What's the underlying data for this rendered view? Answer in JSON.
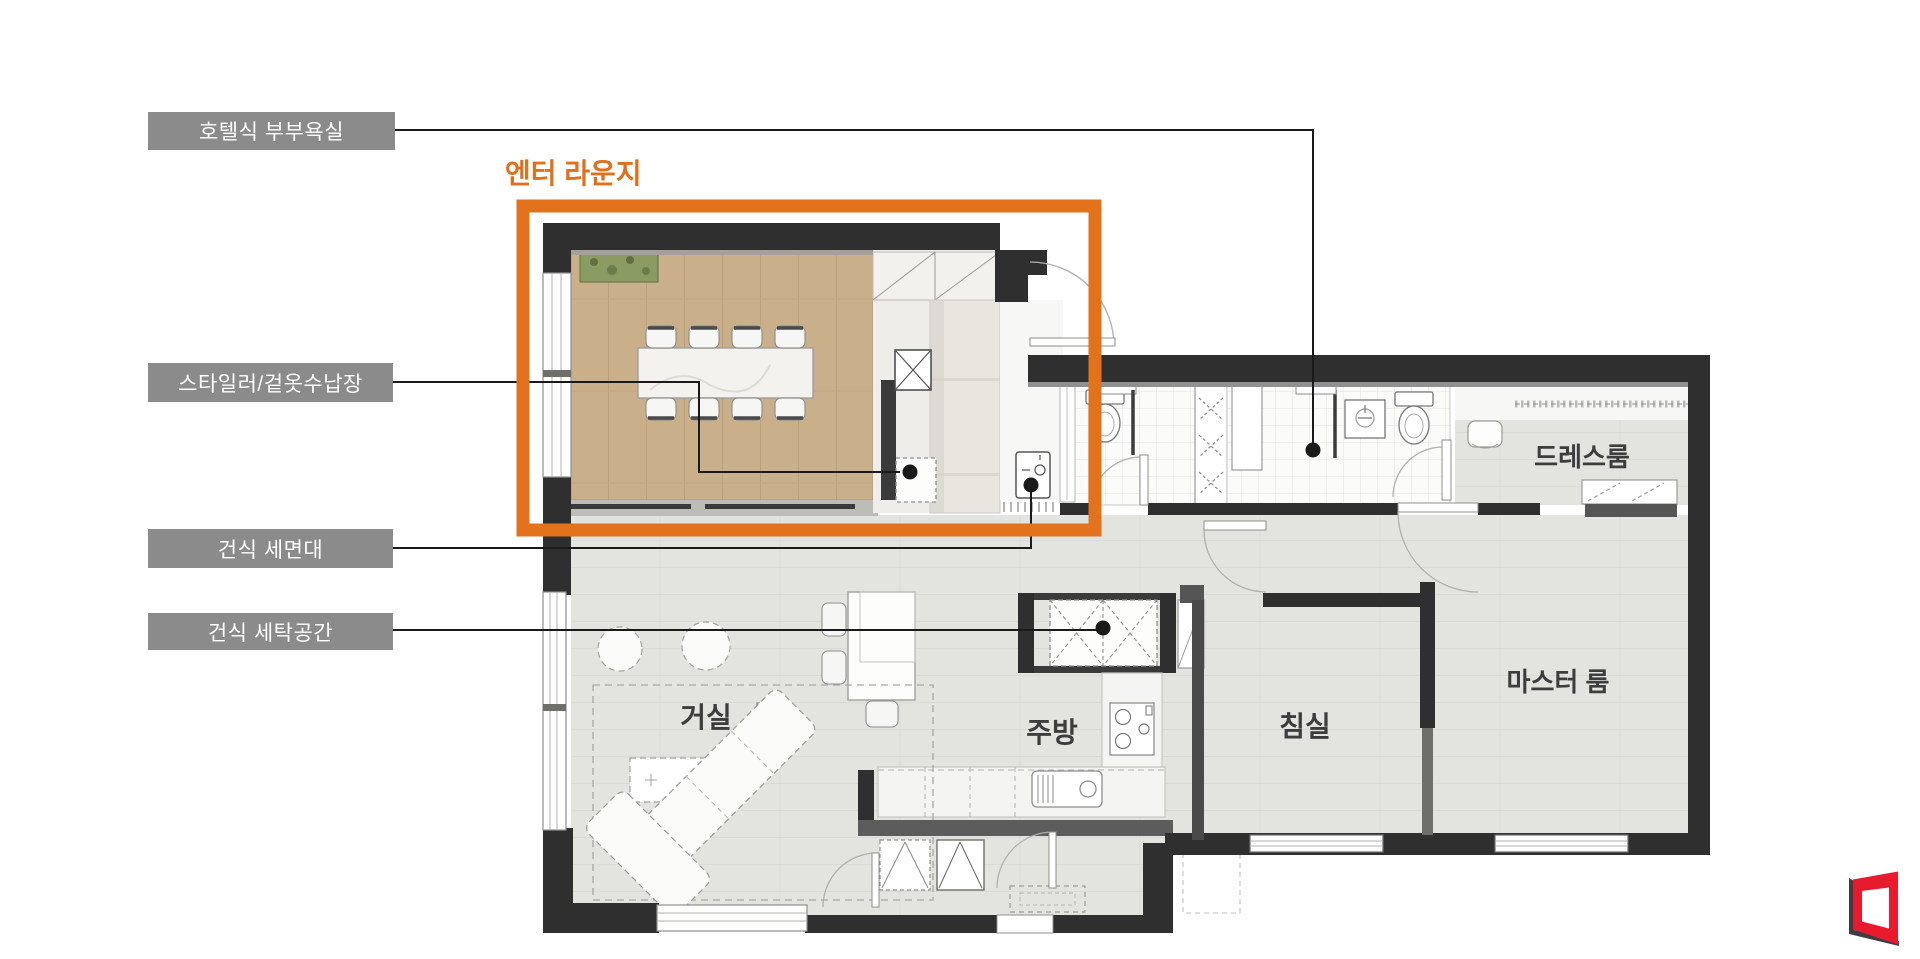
{
  "lounge": {
    "title": "엔터 라운지"
  },
  "callouts": [
    {
      "id": "hotel-couple-bath",
      "label": "호텔식 부부욕실"
    },
    {
      "id": "styler-closet",
      "label": "스타일러/겉옷수납장"
    },
    {
      "id": "dry-washstand",
      "label": "건식 세면대"
    },
    {
      "id": "dry-laundry",
      "label": "건식 세탁공간"
    }
  ],
  "rooms": {
    "dress_room": "드레스룸",
    "living_room": "거실",
    "kitchen": "주방",
    "bedroom": "침실",
    "master_room": "마스터 룸"
  },
  "colors": {
    "accent_orange": "#E2721C",
    "callout_box_gray": "#8B8B8B",
    "wall_dark": "#2F2F2F",
    "wood_floor": "#C9B08B",
    "main_floor": "#E3E4E0",
    "logo_red": "#E81A2D"
  },
  "icons": {
    "logo": "red-frame-logo",
    "callout_dot": "callout-point-dot"
  }
}
